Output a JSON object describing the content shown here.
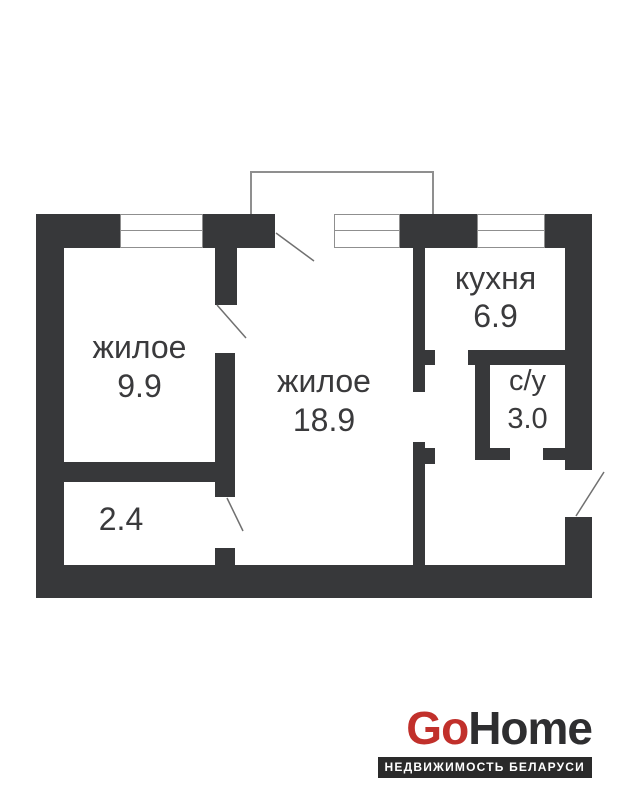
{
  "plan": {
    "rooms": [
      {
        "id": "living-small",
        "label": "жилое",
        "area": "9.9"
      },
      {
        "id": "living-large",
        "label": "жилое",
        "area": "18.9"
      },
      {
        "id": "kitchen",
        "label": "кухня",
        "area": "6.9"
      },
      {
        "id": "bathroom",
        "label": "с/у",
        "area": "3.0"
      },
      {
        "id": "hallway",
        "label": "",
        "area": "2.4"
      }
    ]
  },
  "branding": {
    "logo_go": "Go",
    "logo_home": "Home",
    "tagline": "НЕДВИЖИМОСТЬ БЕЛАРУСИ"
  },
  "colors": {
    "wall": "#37383a",
    "ink": "#3a3a3c",
    "line_gray": "#8f8f8f",
    "swing_gray": "#707070",
    "accent_red": "#c1302b",
    "logo_dark": "#2e2e30",
    "tagline_bg": "#2a2a2a"
  }
}
